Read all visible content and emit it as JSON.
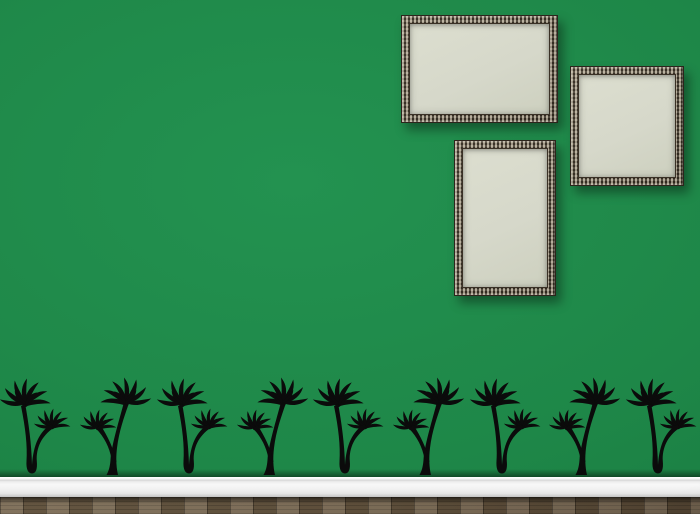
{
  "scene": {
    "description": "green room wall with three empty ornate picture frames and a row of black palm tree wall decals above a white baseboard and wood parquet floor",
    "wall": {
      "color": "#1e8748",
      "shadow_color": "#0d4a26"
    },
    "frames": {
      "style": "ornate silver-bronze beaded frame",
      "canvas_color": "#d6d8ca",
      "items": [
        {
          "id": "frame-landscape",
          "orientation": "landscape",
          "x": 401,
          "y": 15,
          "w": 157,
          "h": 108
        },
        {
          "id": "frame-square",
          "orientation": "square",
          "x": 570,
          "y": 66,
          "w": 114,
          "h": 120
        },
        {
          "id": "frame-portrait",
          "orientation": "portrait",
          "x": 454,
          "y": 140,
          "w": 102,
          "h": 156
        }
      ]
    },
    "decals": {
      "description": "palm tree silhouette decals, two alternating designs",
      "color": "#0b0b0b",
      "count": 9,
      "y": 388,
      "width": 70,
      "height": 90,
      "items": [
        {
          "variant": "A",
          "x": 1
        },
        {
          "variant": "B",
          "x": 80
        },
        {
          "variant": "A",
          "x": 158
        },
        {
          "variant": "B",
          "x": 237
        },
        {
          "variant": "A",
          "x": 314
        },
        {
          "variant": "B",
          "x": 393
        },
        {
          "variant": "A",
          "x": 471
        },
        {
          "variant": "B",
          "x": 549
        },
        {
          "variant": "A",
          "x": 627
        }
      ]
    },
    "baseboard": {
      "color_top": "#fafafa",
      "color_bottom": "#c3c3c3",
      "y": 477,
      "height": 20
    },
    "floor": {
      "type": "wood parquet",
      "color": "#6d5c45",
      "y": 497,
      "height": 17
    }
  }
}
